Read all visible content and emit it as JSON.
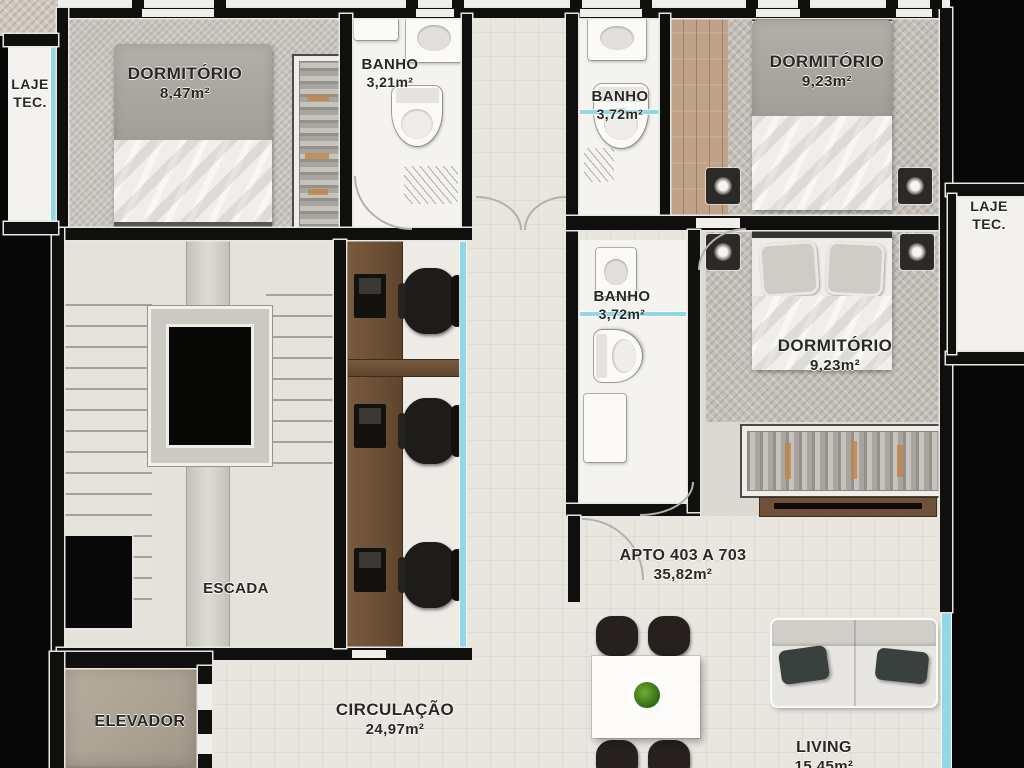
{
  "plan": {
    "rooms": {
      "laje_tec_left": {
        "name": "LAJE TEC."
      },
      "dormitorio_1": {
        "name": "DORMITÓRIO",
        "area": "8,47m²"
      },
      "banho_1": {
        "name": "BANHO",
        "area": "3,21m²"
      },
      "banho_2": {
        "name": "BANHO",
        "area": "3,72m²"
      },
      "dormitorio_2": {
        "name": "DORMITÓRIO",
        "area": "9,23m²"
      },
      "laje_tec_right": {
        "name": "LAJE TEC."
      },
      "banho_3": {
        "name": "BANHO",
        "area": "3,72m²"
      },
      "dormitorio_3": {
        "name": "DORMITÓRIO",
        "area": "9,23m²"
      },
      "escada": {
        "name": "ESCADA"
      },
      "apartamento": {
        "name": "APTO 403 A 703",
        "area": "35,82m²"
      },
      "elevador": {
        "name": "ELEVADOR"
      },
      "circulacao": {
        "name": "CIRCULAÇÃO",
        "area": "24,97m²"
      },
      "living": {
        "name": "LIVING",
        "area_cropped": "15,45m²"
      }
    },
    "colors": {
      "background": "#060606",
      "wall": "#0f0f0e",
      "floor": "#e9e6e0",
      "bathroom_floor": "#f4f3f0",
      "carpet": "#c9c5bf",
      "wood_deck": "#bfa287",
      "glass_window": "#8fd8e8",
      "desk_wood": "#6e5138",
      "elevator_floor": "#b0a697",
      "plant": "#4a8a22"
    }
  }
}
